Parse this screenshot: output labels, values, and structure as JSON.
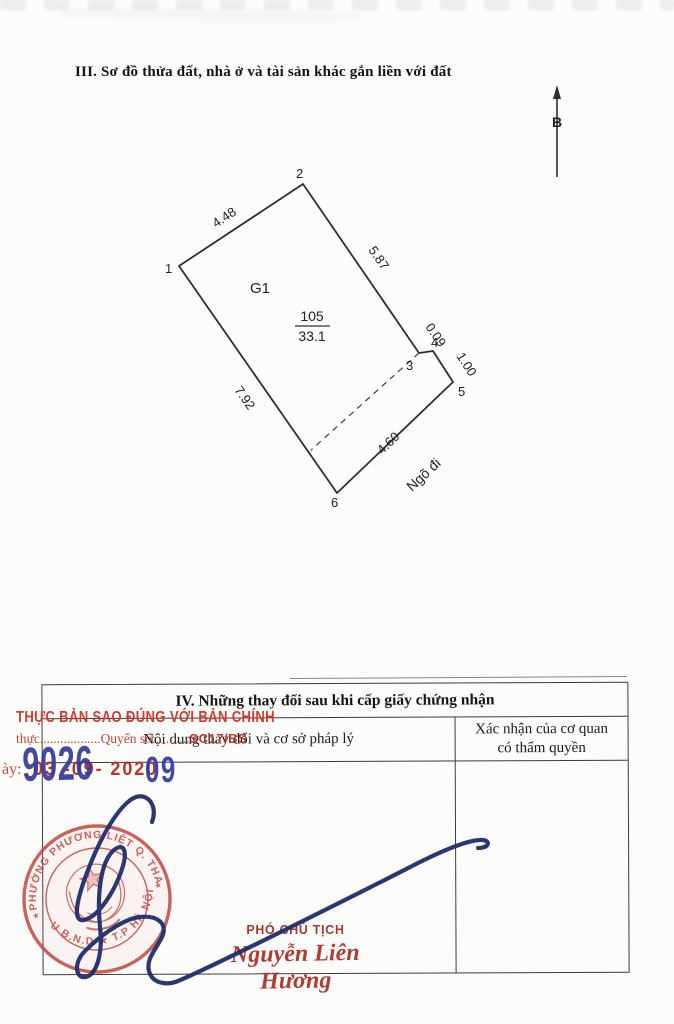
{
  "section3": {
    "title": "III. Sơ đồ thửa đất, nhà ở và tài sản khác gắn liền với đất"
  },
  "diagram": {
    "north_label": "B",
    "zone_label": "G1",
    "parcel_number": "105",
    "parcel_area": "33.1",
    "alley_label": "Ngõ đi",
    "vertex_labels": [
      "1",
      "2",
      "3",
      "4",
      "5",
      "6"
    ],
    "edge_labels": {
      "v1_v2": "4.48",
      "v2_v3": "5.87",
      "v3_v4": "0.09",
      "v4_v5": "1.00",
      "v6_v5": "4.60",
      "v1_v6": "7.92"
    }
  },
  "section4": {
    "title": "IV. Những thay đổi sau khi cấp giấy chứng nhận",
    "col1_header": "Nội dung thay đổi và cơ sở pháp lý",
    "col2_header_line1": "Xác nhận của cơ quan",
    "col2_header_line2": "có thẩm quyền"
  },
  "overlay": {
    "certify_line1": "THỰC BẢN SAO ĐÚNG VỚI BẢN CHÍNH",
    "certify_line2_prefix": "thực",
    "certify_line2_dots1": "..................",
    "certify_line2_label": "Quyển số:",
    "certify_line2_dots2": "..........",
    "certify_line2_value": "SC17/BS",
    "date_prefix": "ày:",
    "date_stamp": "03 -09- 2020",
    "number_large": "9026",
    "number_small": "09",
    "signer_title": "PHÓ CHỦ TỊCH",
    "signer_name": "Nguyễn Liên Hương"
  },
  "seal": {
    "arc_top": "PHƯỜNG PHƯƠNG LIỆT Q. THANH XUÂN",
    "arc_bottom": "U.B.N.D ★ T.P HÀ NỘI",
    "separator": "★"
  },
  "colors": {
    "stamp_red": "#c4463f",
    "certify_red": "#d43b2e",
    "number_blue": "#333a99",
    "signature_blue": "#1e2d6e",
    "ink_black": "#3c3c3c"
  }
}
